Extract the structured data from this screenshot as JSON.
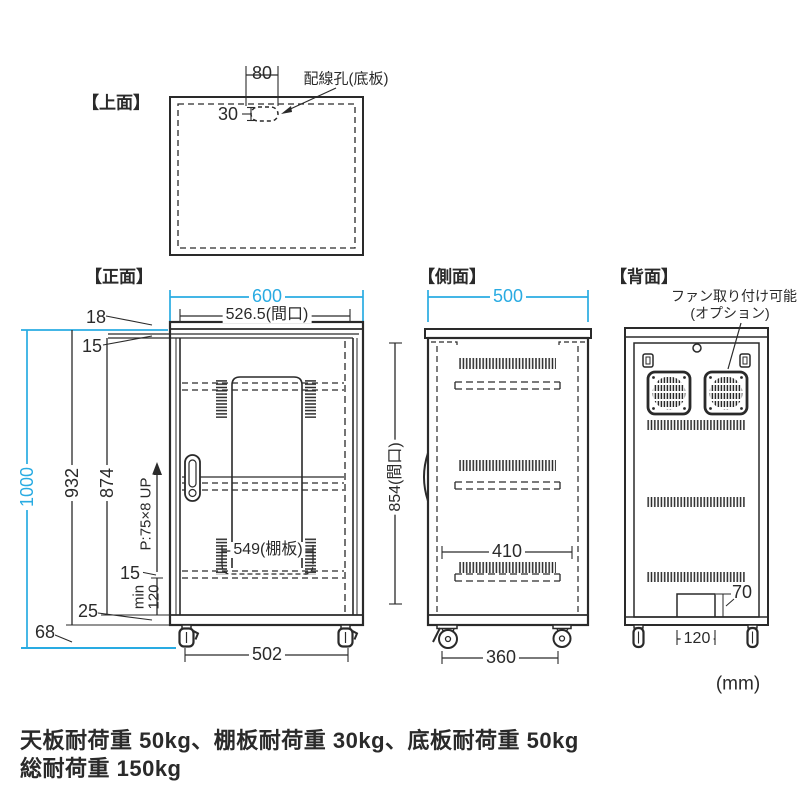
{
  "colors": {
    "line": "#2a2a2a",
    "accent_blue": "#29abe2"
  },
  "unit_label": "(mm)",
  "top_view": {
    "title": "【上面】",
    "hole_width": "80",
    "hole_offset": "30",
    "hole_callout": "配線孔(底板)"
  },
  "front_view": {
    "title": "【正面】",
    "overall_width": "600",
    "opening_width": "526.5(間口)",
    "top_panel": "18",
    "top_gap": "15",
    "overall_height": "1000",
    "body_height": "932",
    "inner_height": "874",
    "shelf_pitch": "P:75×8 UP",
    "shelf_width": "549(棚板)",
    "shelf_thickness": "15",
    "min_label": "min",
    "min_height": "120",
    "base_height": "25",
    "caster_height": "68",
    "caster_span": "502"
  },
  "side_view": {
    "title": "【側面】",
    "overall_depth": "500",
    "opening_height": "854(間口)",
    "inner_depth": "410",
    "caster_span": "360"
  },
  "back_view": {
    "title": "【背面】",
    "fan_callout_1": "ファン取り付け可能",
    "fan_callout_2": "(オプション)",
    "notch_height": "70",
    "notch_width": "120"
  },
  "notes": {
    "load_line": "天板耐荷重 50kg、棚板耐荷重 30kg、底板耐荷重 50kg",
    "total_line": "総耐荷重 150kg"
  }
}
